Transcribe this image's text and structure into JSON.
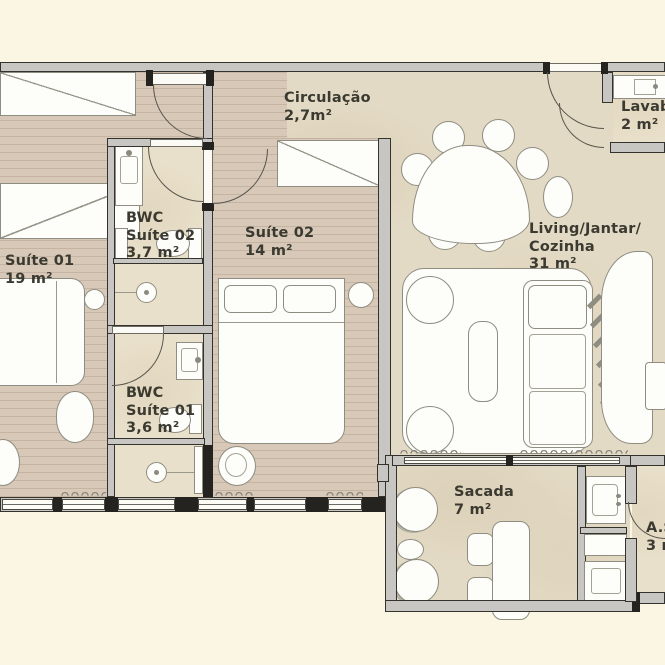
{
  "rooms": {
    "suite01": {
      "lines": [
        "Suíte 01",
        "19 m²"
      ]
    },
    "bwc_suite02": {
      "lines": [
        "BWC",
        "Suíte 02",
        "3,7 m²"
      ]
    },
    "suite02": {
      "lines": [
        "Suíte 02",
        "14 m²"
      ]
    },
    "circulacao": {
      "lines": [
        "Circulação",
        "2,7m²"
      ]
    },
    "living": {
      "lines": [
        "Living/Jantar/",
        "Cozinha",
        "31 m²"
      ]
    },
    "lavabo": {
      "lines": [
        "Lavabo",
        "2 m²"
      ]
    },
    "bwc_suite01": {
      "lines": [
        "BWC",
        "Suíte 01",
        "3,6 m²"
      ]
    },
    "sacada": {
      "lines": [
        "Sacada",
        "7 m²"
      ]
    },
    "area_servico": {
      "lines": [
        "A.S.",
        "3 m²"
      ]
    }
  },
  "colors": {
    "background": "#FBF6E4",
    "wood_floor": "#D7C8B8",
    "travertine_floor": "#E3DAC5",
    "wall": "#C7C6C2",
    "furniture": "#FDFDFA",
    "text": "#3B3A31"
  }
}
